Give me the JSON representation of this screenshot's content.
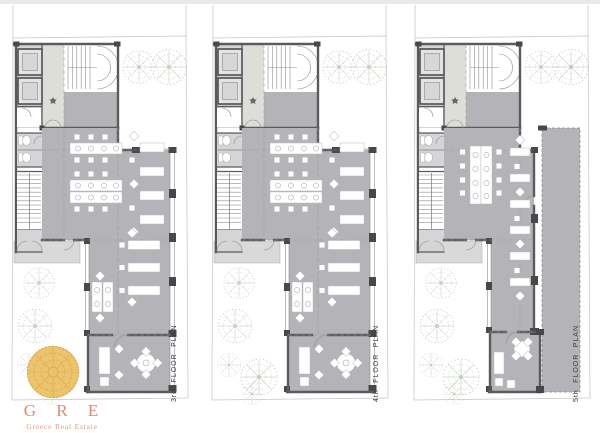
{
  "plans": [
    {
      "id": "3rd",
      "label": "3rd FLOOR PLAN"
    },
    {
      "id": "4th",
      "label": "4th FLOOR PLAN"
    },
    {
      "id": "5th",
      "label": "5th FLOOR PLAN"
    }
  ],
  "logo": {
    "acronym": "G R E",
    "company": "Greece Real Estate"
  },
  "colors": {
    "wall": "#5b5b5d",
    "wallD": "#48484a",
    "room": "#b4b4b8",
    "light": "#d5d5d7",
    "boundary": "#c8c8c8",
    "dash": "#9b9b9b",
    "tree": "#b9c4b6",
    "topbar": "#e8e8e7",
    "gold": "#ecc166",
    "goldLine": "#d69d44",
    "logoText": "#df8a6d",
    "label": "#3a3a3a"
  }
}
